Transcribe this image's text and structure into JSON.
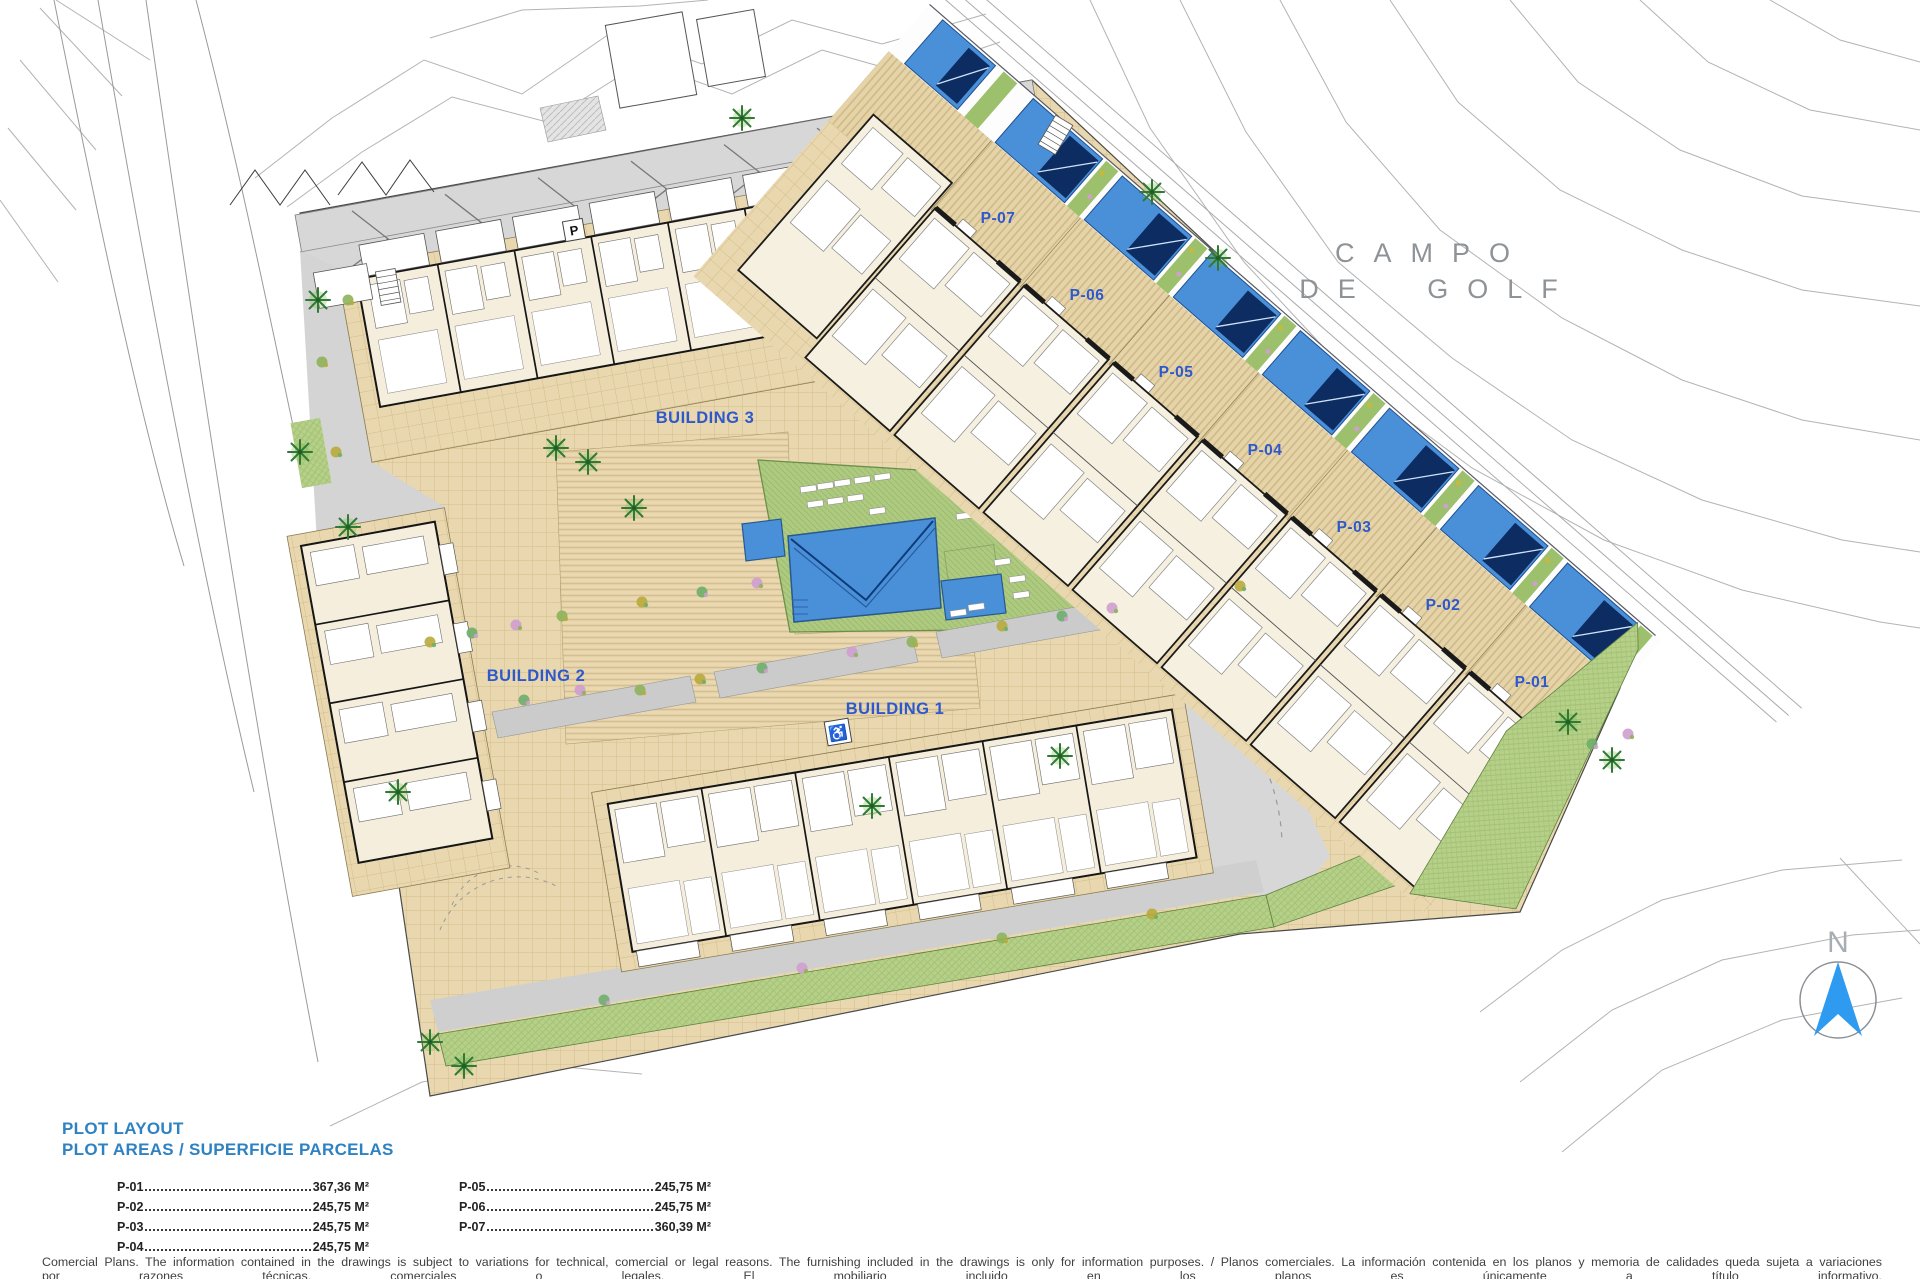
{
  "plan": {
    "golf_label_line1": "CAMPO",
    "golf_label_line2": "DE GOLF",
    "north_label": "N",
    "buildings": [
      {
        "id": "building-1",
        "label": "BUILDING 1"
      },
      {
        "id": "building-2",
        "label": "BUILDING 2"
      },
      {
        "id": "building-3",
        "label": "BUILDING 3"
      }
    ],
    "plots": [
      "P-07",
      "P-06",
      "P-05",
      "P-04",
      "P-03",
      "P-02",
      "P-01"
    ],
    "colors": {
      "plan_label_blue": "#2e59cc",
      "legend_blue": "#2e82c2",
      "pool_blue": "#4a90d8",
      "pool_shade_navy": "#0c2c62",
      "lawn_green": "#aeca80",
      "paving_tan": "#e9d8af",
      "road_gray": "#d7d7d7",
      "north_arrow_blue": "#2e9bf0",
      "golf_text_gray": "#8e9398"
    }
  },
  "legend": {
    "title": "PLOT LAYOUT",
    "subtitle": "PLOT AREAS / SUPERFICIE PARCELAS",
    "areas": [
      {
        "plot": "P-01",
        "area": "367,36 M²"
      },
      {
        "plot": "P-02",
        "area": "245,75 M²"
      },
      {
        "plot": "P-03",
        "area": "245,75 M²"
      },
      {
        "plot": "P-04",
        "area": "245,75 M²"
      },
      {
        "plot": "P-05",
        "area": "245,75 M²"
      },
      {
        "plot": "P-06",
        "area": "245,75 M²"
      },
      {
        "plot": "P-07",
        "area": "360,39 M²"
      }
    ]
  },
  "disclaimer": "Comercial Plans. The information contained in the drawings is subject to variations for technical, comercial or legal reasons. The furnishing included in the drawings is only for information purposes. / Planos comerciales. La información contenida en los planos y memoria de calidades queda sujeta a variaciones por razones técnicas, comerciales o legales. El mobiliario incluido en los planos es únicamente a título informativo."
}
